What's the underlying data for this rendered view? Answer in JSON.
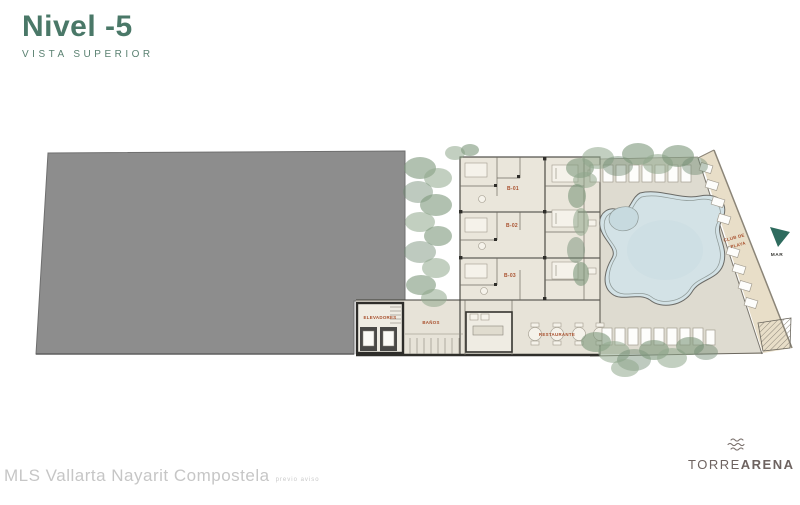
{
  "header": {
    "title": "Nivel -5",
    "subtitle": "VISTA SUPERIOR"
  },
  "plan": {
    "units": [
      {
        "label": "B-01"
      },
      {
        "label": "B-02"
      },
      {
        "label": "B-03"
      }
    ],
    "labels": {
      "elevators": "ELEVADORES",
      "bathrooms": "BAÑOS",
      "restaurant": "RESTAURANTE",
      "beach_club_line1": "CLUB DE",
      "beach_club_line2": "PLAYA",
      "sea": "MAR"
    }
  },
  "footer": {
    "watermark": "MLS Vallarta Nayarit Compostela",
    "watermark_note": "previo aviso"
  },
  "logo": {
    "light": "TORRE",
    "bold": "ARENA",
    "icon": "waves-icon"
  },
  "colors": {
    "title_green": "#4a7868",
    "label_red": "#a84f2c",
    "parking_gray": "#8d8d8d",
    "floor_beige": "#eae6db",
    "deck_gray": "#dedbd0",
    "water_blue": "#d3e2e6",
    "sand": "#e8dec8",
    "tree_green": "#7d977b",
    "sea_arrow_teal": "#2e6b5e",
    "watermark_gray": "#c6c6c6",
    "logo_brown": "#6e6360"
  }
}
